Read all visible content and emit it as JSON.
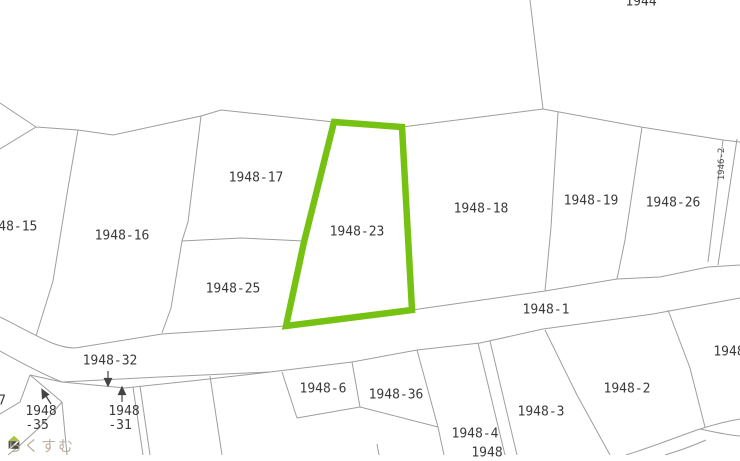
{
  "map": {
    "type": "cadastral-parcel-map",
    "selected_parcel": "1948-23",
    "highlight_color": "#76c213",
    "line_color": "#9e9e9e",
    "labels": [
      {
        "id": "1944",
        "text": "1944"
      },
      {
        "id": "1948-15",
        "text": "1948-15"
      },
      {
        "id": "1948-16",
        "text": "1948-16"
      },
      {
        "id": "1948-17",
        "text": "1948-17"
      },
      {
        "id": "1948-25",
        "text": "1948-25"
      },
      {
        "id": "1948-23",
        "text": "1948-23"
      },
      {
        "id": "1948-18",
        "text": "1948-18"
      },
      {
        "id": "1948-19",
        "text": "1948-19"
      },
      {
        "id": "1948-26",
        "text": "1948-26"
      },
      {
        "id": "1946-2",
        "text": "1946-2"
      },
      {
        "id": "1948-1",
        "text": "1948-1"
      },
      {
        "id": "1948-32",
        "text": "1948-32"
      },
      {
        "id": "1948-35",
        "line1": "1948",
        "line2": "-35"
      },
      {
        "id": "1948-31",
        "line1": "1948",
        "line2": "-31"
      },
      {
        "id": "1948-6",
        "text": "1948-6"
      },
      {
        "id": "1948-36",
        "text": "1948-36"
      },
      {
        "id": "1948-4",
        "text": "1948-4"
      },
      {
        "id": "1948-bottom-partial",
        "text": "1948"
      },
      {
        "id": "1948-3",
        "text": "1948-3"
      },
      {
        "id": "1948-2",
        "text": "1948-2"
      },
      {
        "id": "1948-right-partial",
        "text": "1948"
      },
      {
        "id": "left-edge-partial",
        "text": "7"
      }
    ]
  },
  "watermark": {
    "brand": "らくすむ",
    "logo_roof_color": "#a6c832",
    "logo_body_color": "#4f4b46"
  }
}
